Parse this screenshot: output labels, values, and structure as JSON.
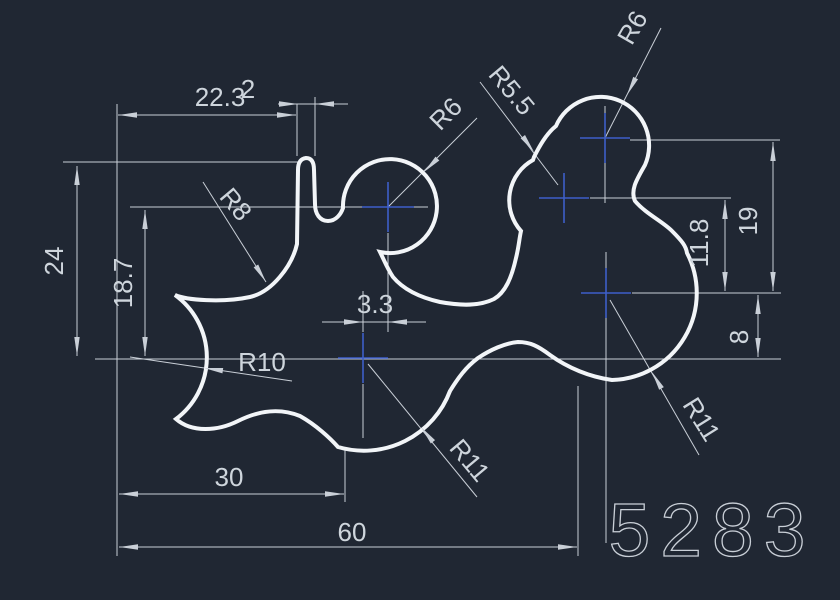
{
  "drawing": {
    "number": "5283",
    "dimensions": {
      "top_width": "22.3",
      "rib_width": "2",
      "left_height": "24",
      "left_inner_height": "18.7",
      "center_offset": "3.3",
      "bottom_width": "30",
      "total_width": "60",
      "right_height": "19",
      "right_inner_height": "11.8",
      "right_lower_height": "8"
    },
    "radii": {
      "fillet_left": "R8",
      "circle_left": "R6",
      "circle_small": "R5.5",
      "circle_top_right": "R6",
      "arc_left": "R10",
      "arc_bottom": "R11",
      "arc_right": "R11"
    },
    "colors": {
      "background": "#202733",
      "line": "#c9cfd7",
      "contour": "#f2f5f8",
      "center_mark": "#3d5fc9",
      "text": "#ced5dc"
    }
  }
}
